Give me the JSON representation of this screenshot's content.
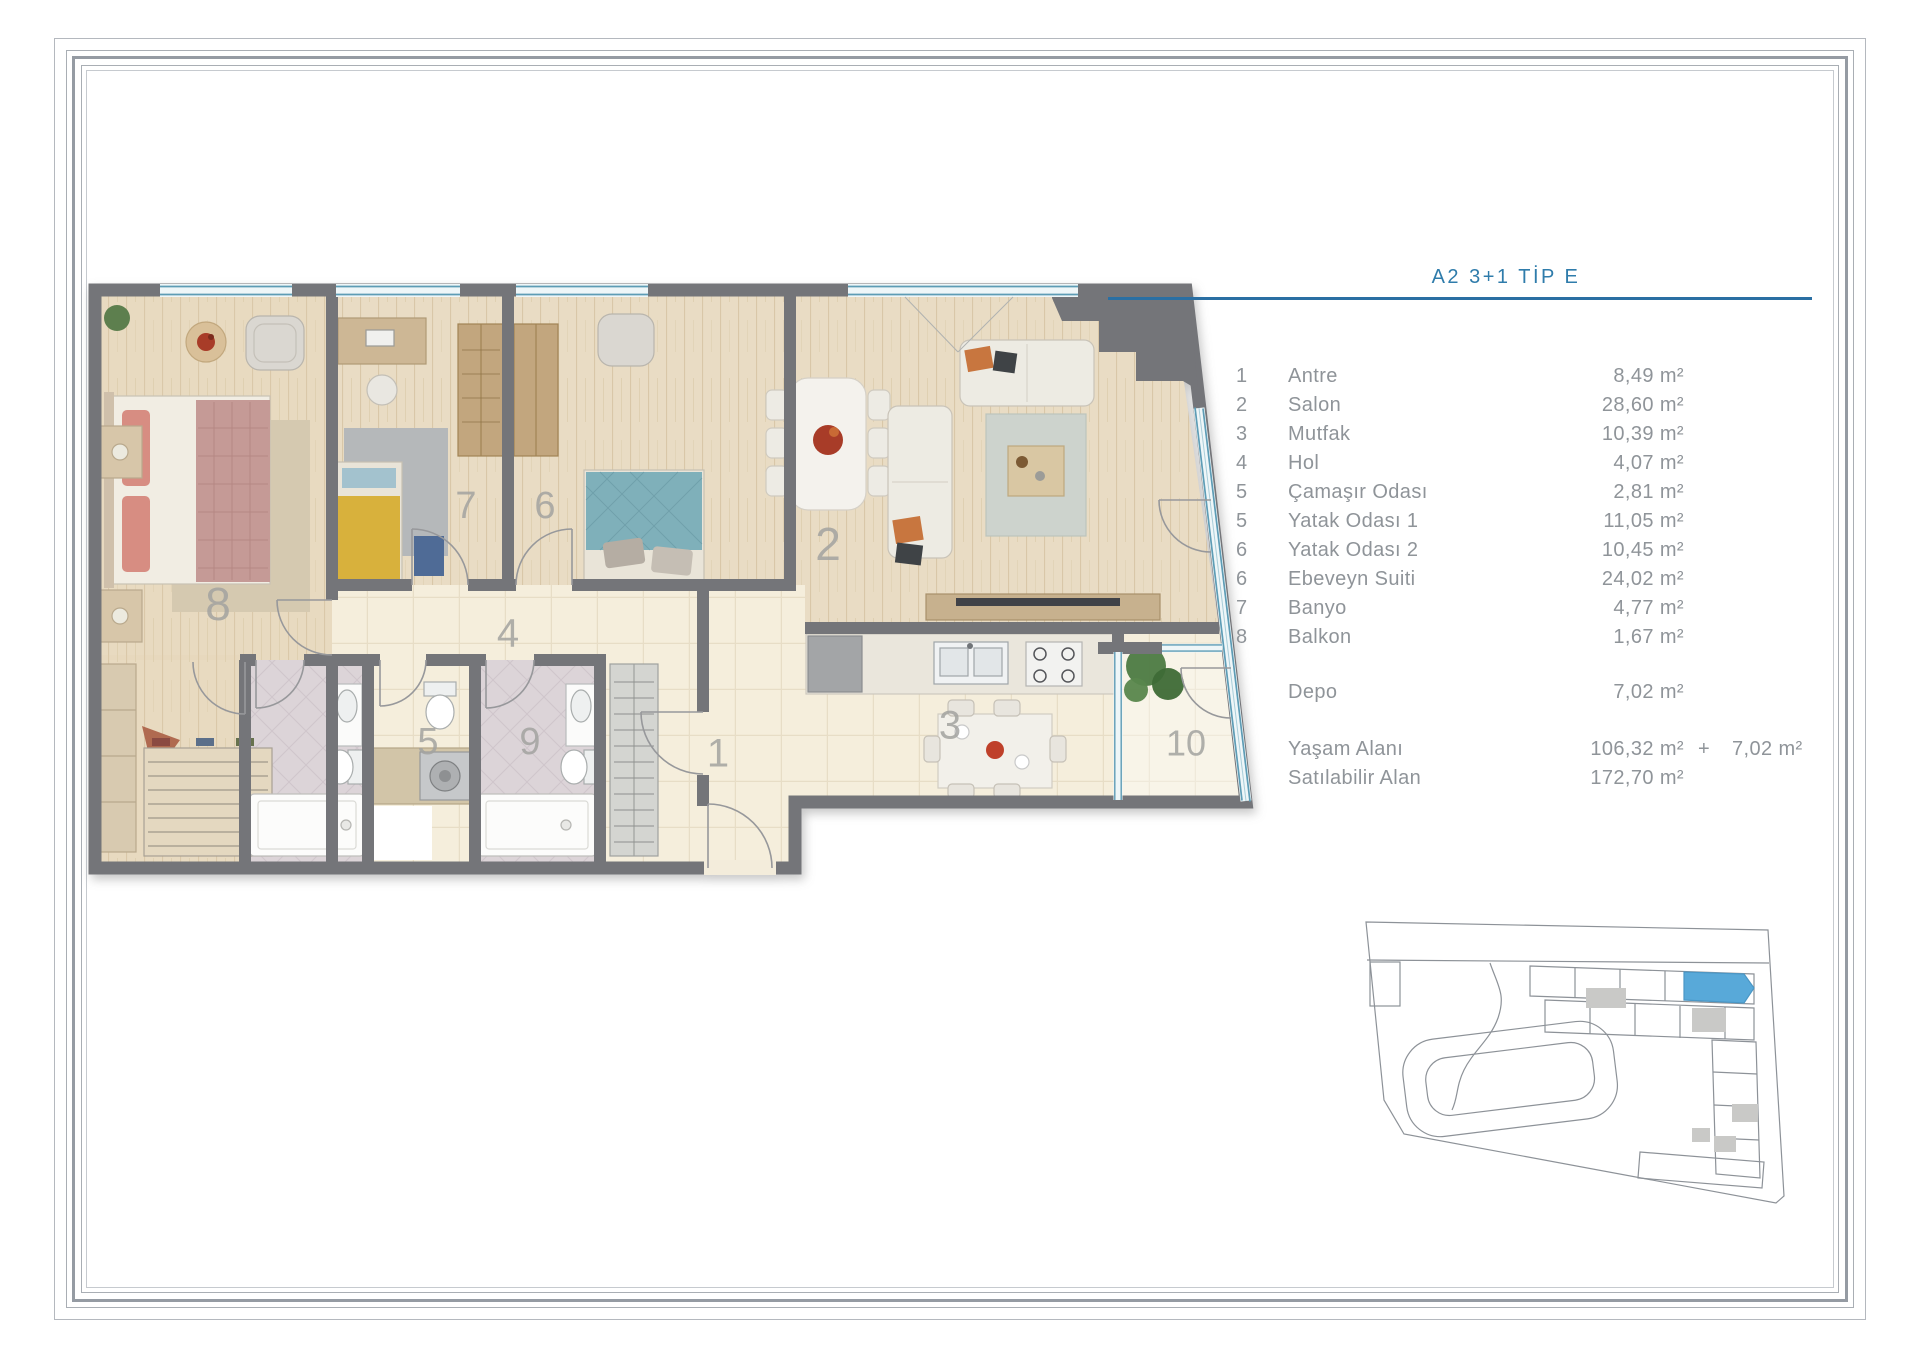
{
  "legend": {
    "title": "A2 3+1 TİP E",
    "rows": [
      {
        "num": "1",
        "name": "Antre",
        "area": "8,49 m²"
      },
      {
        "num": "2",
        "name": "Salon",
        "area": "28,60 m²"
      },
      {
        "num": "3",
        "name": "Mutfak",
        "area": "10,39 m²"
      },
      {
        "num": "4",
        "name": "Hol",
        "area": "4,07 m²"
      },
      {
        "num": "5",
        "name": "Çamaşır Odası",
        "area": "2,81 m²"
      },
      {
        "num": "5",
        "name": "Yatak Odası 1",
        "area": "11,05 m²"
      },
      {
        "num": "6",
        "name": "Yatak Odası 2",
        "area": "10,45 m²"
      },
      {
        "num": "6",
        "name": "Ebeveyn Suiti",
        "area": "24,02 m²"
      },
      {
        "num": "7",
        "name": "Banyo",
        "area": "4,77 m²"
      },
      {
        "num": "8",
        "name": "Balkon",
        "area": "1,67 m²"
      }
    ],
    "storage": {
      "name": "Depo",
      "area": "7,02 m²"
    },
    "totals": [
      {
        "name": "Yaşam Alanı",
        "area": "106,32 m²",
        "plus": "+",
        "extra": "7,02 m²"
      },
      {
        "name": "Satılabilir Alan",
        "area": "172,70 m²",
        "plus": "",
        "extra": ""
      }
    ]
  },
  "plan": {
    "rooms": [
      {
        "label": "1"
      },
      {
        "label": "2"
      },
      {
        "label": "3"
      },
      {
        "label": "4"
      },
      {
        "label": "5"
      },
      {
        "label": "6"
      },
      {
        "label": "7"
      },
      {
        "label": "8"
      },
      {
        "label": "9"
      },
      {
        "label": "10"
      }
    ]
  },
  "colors": {
    "accent_blue": "#2f7cab",
    "legend_text": "#8f9499",
    "wall_gray": "#747579",
    "highlighted_unit": "#58a9d9"
  }
}
